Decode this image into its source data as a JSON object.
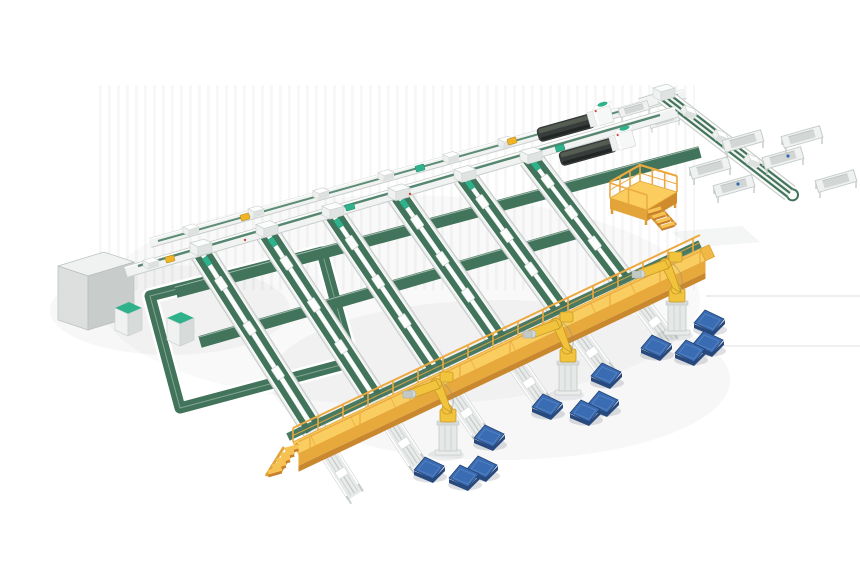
{
  "scene": {
    "title": "Automated panel sorting and palletizing line - isometric 3D factory layout",
    "description": "3D render on white background: dual main transfer conveyors feed six inclined green sorting belt lanes; two dark processing machines sit on the main lines; a green tray conveyor with drop stations runs to the upper right beside a yellow maintenance platform; an elevated yellow service walkway with guard rails and stairs crosses the lane ends; roller outfeed conveyors pass under it to three yellow palletizing robot arms that place product onto blue pallets scattered on the floor."
  },
  "colors": {
    "bg": "#ffffff",
    "belt": "#41745a",
    "belt-light": "#4d8168",
    "teal": "#2fb28b",
    "frame": "#f1f3f2",
    "frame-gray": "#c9cfcc",
    "machine": "#383d3b",
    "wk-top": "#f9cd5f",
    "wk-side": "#e8a93c",
    "wk-dark": "#c9882e",
    "fence": "#eca93f",
    "robot": "#f2c33c",
    "robot-dark": "#c79a27",
    "pallet": "#3a6cb4",
    "pallet-dark": "#27497e",
    "accent": "#f0b429",
    "tread": "#f6c353",
    "riser": "#c87f2e",
    "pf-floor": "#fbcd5e",
    "pf-side": "#d99b33"
  },
  "components": {
    "main_line_upper": {
      "label": "Upper main transfer conveyor",
      "modules": 6
    },
    "main_line_lower": {
      "label": "Lower main transfer conveyor",
      "lane_junctions": 6
    },
    "sorting_lanes": {
      "label": "Inclined green sorting belt lanes",
      "count": 6
    },
    "cross_belts": {
      "label": "Wide green cross-transfer belts",
      "count": 2
    },
    "return_loop": {
      "label": "Return loop belt conveyor (left)"
    },
    "processing_machines": {
      "label": "Dark processing machines with white heads",
      "count": 2
    },
    "maintenance_platform": {
      "label": "Yellow fenced maintenance platform with stairs"
    },
    "tray_section": {
      "label": "Green multi-track tray conveyor with drop stations",
      "tray_stations": 6,
      "benches": 2
    },
    "walkway": {
      "label": "Elevated yellow service walkway with guard rails and stairs"
    },
    "collector_belt": {
      "label": "Green collector belt along walkway"
    },
    "outfeed_conveyors": {
      "label": "Roller outfeed conveyors under walkway",
      "count": 6
    },
    "robots": {
      "label": "Yellow palletizing robot arms",
      "count": 3
    },
    "pallets": {
      "label": "Blue floor pallets",
      "count": 12
    },
    "cabinets": {
      "label": "Electrical cabinet (gray) and teal-top control cabinets",
      "count": 3
    }
  }
}
